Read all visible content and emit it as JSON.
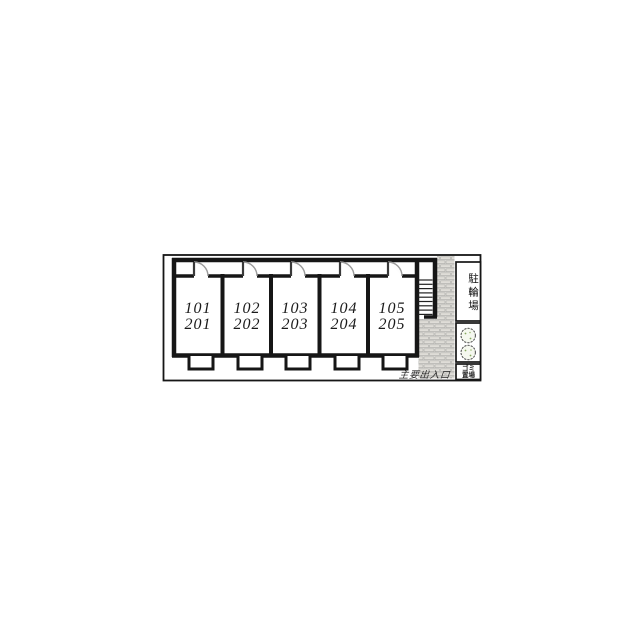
{
  "plan": {
    "units": [
      {
        "first_floor": "101",
        "second_floor": "201"
      },
      {
        "first_floor": "102",
        "second_floor": "202"
      },
      {
        "first_floor": "103",
        "second_floor": "203"
      },
      {
        "first_floor": "104",
        "second_floor": "204"
      },
      {
        "first_floor": "105",
        "second_floor": "205"
      }
    ],
    "labels": {
      "bicycle_parking": "駐輪場",
      "garbage_line1": "ゴミ",
      "garbage_line2": "置場",
      "main_entrance": "主要出入口"
    },
    "colors": {
      "line": "#161616",
      "brick_fill": "#dfddd8",
      "brick_mortar": "#eceae6",
      "tree_green": "#86a85f"
    }
  }
}
